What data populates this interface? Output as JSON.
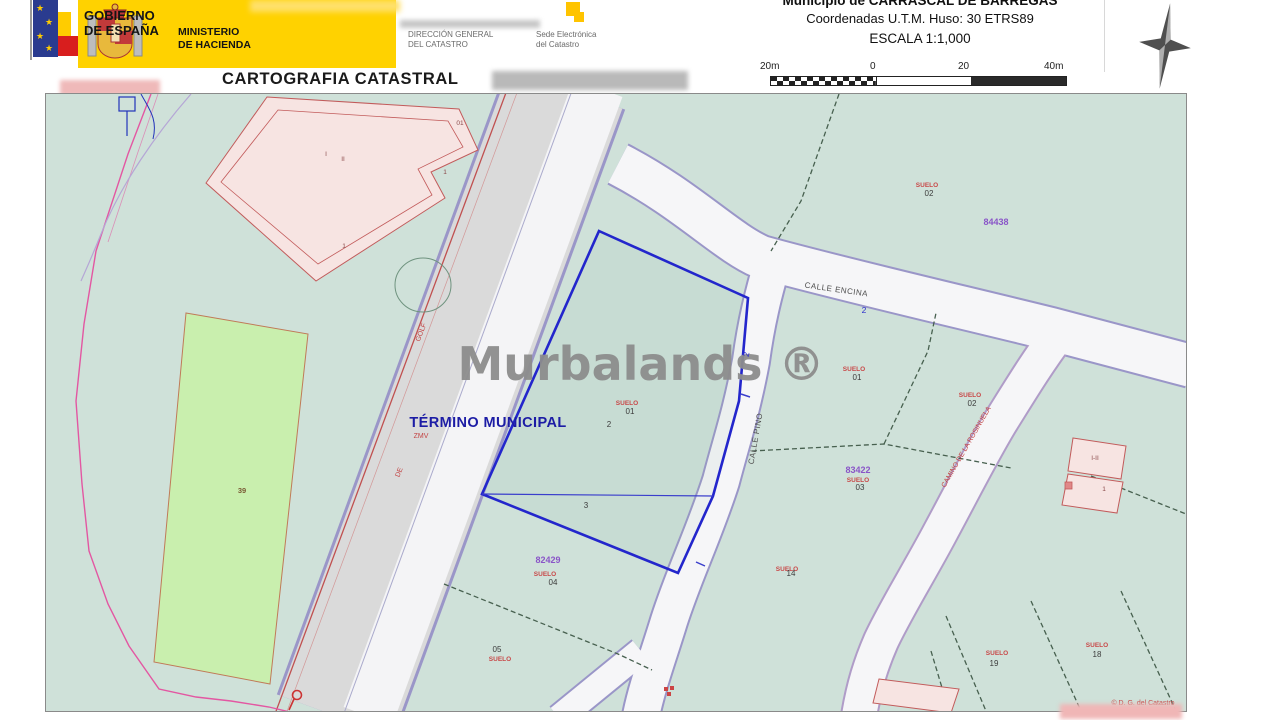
{
  "header": {
    "gobierno_line1": "GOBIERNO",
    "gobierno_line2": "DE ESPAÑA",
    "ministerio_line1": "MINISTERIO",
    "ministerio_line2": "DE HACIENDA",
    "dgc_line1": "DIRECCIÓN GENERAL",
    "dgc_line2": "DEL CATASTRO",
    "sede_line1": "Sede Electrónica",
    "sede_line2": "del Catastro"
  },
  "title": "CARTOGRAFIA CATASTRAL",
  "municipality": {
    "title": "Municipio de CARRASCAL DE BARREGAS",
    "coords": "Coordenadas U.T.M. Huso: 30 ETRS89",
    "scale": "ESCALA 1:1,000",
    "scale_bar_labels": [
      "20m",
      "0",
      "20",
      "40m"
    ]
  },
  "colors": {
    "header_yellow": "#ffd200",
    "map_background": "#cfe1d9",
    "green_parcel": "#c9efae",
    "building_fill": "#f7e4e2",
    "building_outline": "#c25b5b",
    "road_casing": "#9a96c8",
    "bold_parcel_blue": "#2326cc",
    "label_red": "#c84848",
    "label_purple": "#8a55c8",
    "boundary_magenta": "#e357a2",
    "watermark_gray": "#8d8d8d"
  },
  "map": {
    "watermark": "Murbalands ®",
    "copyright": "© D. G. del Catastro",
    "labels": [
      {
        "text": "Murbalands ®",
        "x": 595,
        "y": 286,
        "cls": "lb-watermark",
        "name": "watermark"
      },
      {
        "text": "TÉRMINO MUNICIPAL",
        "x": 442,
        "y": 333,
        "cls": "lb-termino",
        "name": "termino-municipal-label"
      },
      {
        "text": "ZMV",
        "x": 375,
        "y": 344,
        "cls": "lb-redstreet",
        "name": "termino-sub-label"
      },
      {
        "text": "CALLE ENCINA",
        "x": 790,
        "y": 198,
        "cls": "lb-street",
        "rot": 8,
        "name": "street-label-encina"
      },
      {
        "text": "CALLE PINO",
        "x": 712,
        "y": 345,
        "cls": "lb-street",
        "rot": -80,
        "name": "street-label-pino"
      },
      {
        "text": "CAMINO DE LA ROSINUELA",
        "x": 922,
        "y": 354,
        "cls": "lb-redstreet",
        "rot": -60,
        "name": "street-label-camino"
      },
      {
        "text": "GOLF",
        "x": 377,
        "y": 239,
        "cls": "lb-redstreet",
        "rot": -69,
        "name": "street-label-golf"
      },
      {
        "text": "DE",
        "x": 355,
        "y": 379,
        "cls": "lb-redstreet",
        "rot": -69,
        "name": "street-label-de"
      },
      {
        "text": "2",
        "x": 818,
        "y": 219,
        "cls": "lb-blue",
        "name": "road-number"
      },
      {
        "text": "2",
        "x": 703,
        "y": 261,
        "cls": "lb-blue",
        "rot": -78,
        "name": "road-number"
      },
      {
        "text": "01",
        "x": 414,
        "y": 31,
        "cls": "lb-bld",
        "name": "building-label"
      },
      {
        "text": "I",
        "x": 280,
        "y": 62,
        "cls": "lb-bld",
        "name": "building-label"
      },
      {
        "text": "II",
        "x": 297,
        "y": 67,
        "cls": "lb-bld",
        "name": "building-label"
      },
      {
        "text": "1",
        "x": 399,
        "y": 80,
        "cls": "lb-bld",
        "name": "building-label"
      },
      {
        "text": "1",
        "x": 298,
        "y": 154,
        "cls": "lb-bld",
        "name": "building-label"
      },
      {
        "text": "39",
        "x": 196,
        "y": 399,
        "cls": "lb-brown",
        "name": "parcel-label"
      },
      {
        "text": "SUELO",
        "x": 881,
        "y": 93,
        "cls": "lb-red",
        "name": "parcel-label"
      },
      {
        "text": "02",
        "x": 883,
        "y": 102,
        "cls": "lb-dark",
        "name": "parcel-label"
      },
      {
        "text": "84438",
        "x": 950,
        "y": 131,
        "cls": "lb-purple",
        "name": "block-label"
      },
      {
        "text": "SUELO",
        "x": 581,
        "y": 311,
        "cls": "lb-red",
        "name": "parcel-label"
      },
      {
        "text": "01",
        "x": 584,
        "y": 320,
        "cls": "lb-dark",
        "name": "parcel-label"
      },
      {
        "text": "2",
        "x": 563,
        "y": 333,
        "cls": "lb-dark",
        "name": "parcel-label"
      },
      {
        "text": "3",
        "x": 540,
        "y": 414,
        "cls": "lb-dark",
        "name": "parcel-label"
      },
      {
        "text": "SUELO",
        "x": 808,
        "y": 277,
        "cls": "lb-red",
        "name": "parcel-label"
      },
      {
        "text": "01",
        "x": 811,
        "y": 286,
        "cls": "lb-dark",
        "name": "parcel-label"
      },
      {
        "text": "SUELO",
        "x": 924,
        "y": 303,
        "cls": "lb-red",
        "name": "parcel-label"
      },
      {
        "text": "02",
        "x": 926,
        "y": 312,
        "cls": "lb-dark",
        "name": "parcel-label"
      },
      {
        "text": "83422",
        "x": 812,
        "y": 379,
        "cls": "lb-purple",
        "name": "block-label"
      },
      {
        "text": "SUELO",
        "x": 812,
        "y": 388,
        "cls": "lb-red",
        "name": "parcel-label"
      },
      {
        "text": "03",
        "x": 814,
        "y": 396,
        "cls": "lb-dark",
        "name": "parcel-label"
      },
      {
        "text": "SUELO",
        "x": 741,
        "y": 477,
        "cls": "lb-red",
        "name": "parcel-label"
      },
      {
        "text": "14",
        "x": 745,
        "y": 482,
        "cls": "lb-dark",
        "name": "parcel-label"
      },
      {
        "text": "82429",
        "x": 502,
        "y": 469,
        "cls": "lb-purple",
        "name": "block-label"
      },
      {
        "text": "SUELO",
        "x": 499,
        "y": 482,
        "cls": "lb-red",
        "name": "parcel-label"
      },
      {
        "text": "04",
        "x": 507,
        "y": 491,
        "cls": "lb-dark",
        "name": "parcel-label"
      },
      {
        "text": "05",
        "x": 451,
        "y": 558,
        "cls": "lb-dark",
        "name": "parcel-label"
      },
      {
        "text": "SUELO",
        "x": 454,
        "y": 567,
        "cls": "lb-red",
        "name": "parcel-label"
      },
      {
        "text": "SUELO",
        "x": 951,
        "y": 561,
        "cls": "lb-red",
        "name": "parcel-label"
      },
      {
        "text": "19",
        "x": 948,
        "y": 572,
        "cls": "lb-dark",
        "name": "parcel-label"
      },
      {
        "text": "SUELO",
        "x": 1051,
        "y": 553,
        "cls": "lb-red",
        "name": "parcel-label"
      },
      {
        "text": "18",
        "x": 1051,
        "y": 563,
        "cls": "lb-dark",
        "name": "parcel-label"
      },
      {
        "text": "I-II",
        "x": 1049,
        "y": 366,
        "cls": "lb-bld",
        "name": "building-label"
      },
      {
        "text": "1",
        "x": 1058,
        "y": 397,
        "cls": "lb-bld",
        "name": "building-label"
      },
      {
        "text": "© D. G. del Catastro",
        "x": 1097,
        "y": 611,
        "cls": "lb-redstreet",
        "name": "copyright-label"
      }
    ]
  }
}
